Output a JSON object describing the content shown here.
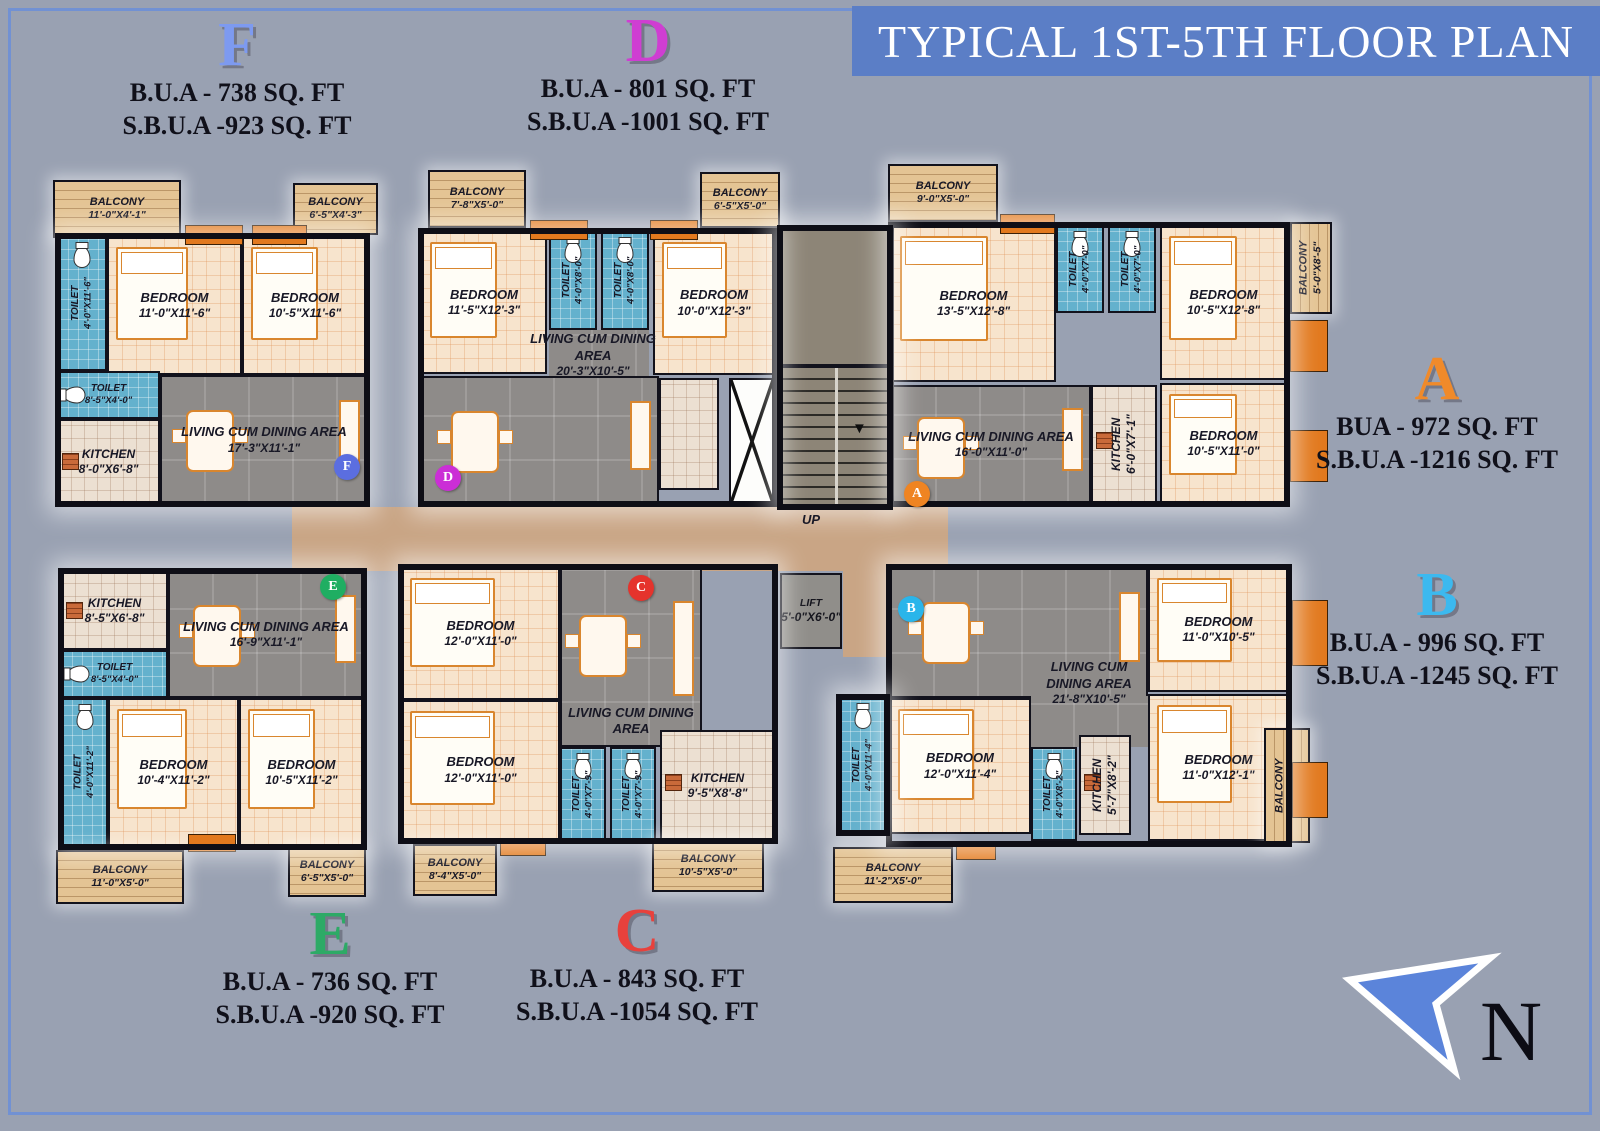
{
  "title": "TYPICAL 1ST-5TH FLOOR PLAN",
  "north": {
    "label": "N"
  },
  "units": [
    {
      "id": "F",
      "letter": "F",
      "color": "#7d9af0",
      "bua": "B.U.A - 738 SQ. FT",
      "sbua": "S.B.U.A -923 SQ. FT"
    },
    {
      "id": "D",
      "letter": "D",
      "color": "#cf3ed2",
      "bua": "B.U.A - 801 SQ. FT",
      "sbua": "S.B.U.A -1001 SQ. FT"
    },
    {
      "id": "A",
      "letter": "A",
      "color": "#f08a2a",
      "bua": "BUA - 972 SQ. FT",
      "sbua": "S.B.U.A -1216 SQ. FT"
    },
    {
      "id": "B",
      "letter": "B",
      "color": "#3cb9ef",
      "bua": "B.U.A - 996 SQ. FT",
      "sbua": "S.B.U.A -1245 SQ. FT"
    },
    {
      "id": "E",
      "letter": "E",
      "color": "#2daa66",
      "bua": "B.U.A - 736 SQ. FT",
      "sbua": "S.B.U.A -920 SQ. FT"
    },
    {
      "id": "C",
      "letter": "C",
      "color": "#e8413c",
      "bua": "B.U.A - 843 SQ. FT",
      "sbua": "S.B.U.A -1054 SQ. FT"
    }
  ],
  "markers": [
    {
      "u": "F",
      "x": 334,
      "y": 454,
      "color": "#5b6ee0"
    },
    {
      "u": "D",
      "x": 435,
      "y": 465,
      "color": "#cb2ed6"
    },
    {
      "u": "A",
      "x": 904,
      "y": 481,
      "color": "#ef8422"
    },
    {
      "u": "E",
      "x": 320,
      "y": 574,
      "color": "#1fae62"
    },
    {
      "u": "C",
      "x": 628,
      "y": 575,
      "color": "#e5332c"
    },
    {
      "u": "B",
      "x": 898,
      "y": 596,
      "color": "#2ab5ea"
    }
  ],
  "rooms": [
    {
      "u": "core",
      "k": "cor",
      "x": 292,
      "y": 507,
      "w": 656,
      "h": 64
    },
    {
      "u": "core",
      "k": "cor",
      "x": 843,
      "y": 569,
      "w": 46,
      "h": 88
    },
    {
      "u": "F",
      "k": "bal",
      "n": "BALCONY",
      "d": "11'-0\"X4'-1\"",
      "x": 53,
      "y": 180,
      "w": 128,
      "h": 58
    },
    {
      "u": "F",
      "k": "bal",
      "n": "BALCONY",
      "d": "6'-5\"X4'-3\"",
      "x": 293,
      "y": 183,
      "w": 85,
      "h": 52
    },
    {
      "u": "F",
      "k": "toi",
      "v": 1,
      "n": "TOILET",
      "d": "4'-0\"X11'-6\"",
      "x": 57,
      "y": 236,
      "w": 50,
      "h": 135
    },
    {
      "u": "F",
      "k": "bed",
      "n": "BEDROOM",
      "d": "11'-0\"X11'-6\"",
      "x": 107,
      "y": 236,
      "w": 135,
      "h": 139
    },
    {
      "u": "F",
      "k": "bed",
      "n": "BEDROOM",
      "d": "10'-5\"X11'-6\"",
      "x": 242,
      "y": 236,
      "w": 126,
      "h": 139
    },
    {
      "u": "F",
      "k": "toi",
      "n": "TOILET",
      "d": "8'-5\"X4'-0\"",
      "x": 57,
      "y": 371,
      "w": 103,
      "h": 48
    },
    {
      "u": "F",
      "k": "kit",
      "n": "KITCHEN",
      "d": "8'-0\"X6'-8\"",
      "x": 57,
      "y": 419,
      "w": 103,
      "h": 86
    },
    {
      "u": "F",
      "k": "liv",
      "n": "LIVING CUM DINING AREA",
      "d": "17'-3\"X11'-1\"",
      "x": 160,
      "y": 375,
      "w": 208,
      "h": 130
    },
    {
      "u": "D",
      "k": "bal",
      "n": "BALCONY",
      "d": "7'-8\"X5'-0\"",
      "x": 428,
      "y": 170,
      "w": 98,
      "h": 58
    },
    {
      "u": "D",
      "k": "bal",
      "n": "BALCONY",
      "d": "6'-5\"X5'-0\"",
      "x": 700,
      "y": 172,
      "w": 80,
      "h": 56
    },
    {
      "u": "D",
      "k": "bed",
      "n": "BEDROOM",
      "d": "11'-5\"X12'-3\"",
      "x": 421,
      "y": 231,
      "w": 126,
      "h": 143
    },
    {
      "u": "D",
      "k": "toi",
      "v": 1,
      "n": "TOILET",
      "d": "4'-0\"X8'-0\"",
      "x": 549,
      "y": 231,
      "w": 48,
      "h": 99
    },
    {
      "u": "D",
      "k": "toi",
      "v": 1,
      "n": "TOILET",
      "d": "4'-0\"X8'-0\"",
      "x": 601,
      "y": 231,
      "w": 48,
      "h": 99
    },
    {
      "u": "D",
      "k": "bed",
      "n": "BEDROOM",
      "d": "10'-0\"X12'-3\"",
      "x": 653,
      "y": 231,
      "w": 122,
      "h": 144
    },
    {
      "u": "D",
      "k": "livplain",
      "x": 549,
      "y": 330,
      "w": 100,
      "h": 48
    },
    {
      "u": "D",
      "k": "liv",
      "x": 421,
      "y": 376,
      "w": 238,
      "h": 129
    },
    {
      "u": "D",
      "k": "label",
      "n": "LIVING CUM DINING AREA",
      "d": "20'-3\"X10'-5\"",
      "x": 523,
      "y": 331,
      "w": 140,
      "h": 48
    },
    {
      "u": "D",
      "k": "kit",
      "x": 659,
      "y": 378,
      "w": 60,
      "h": 112
    },
    {
      "u": "D",
      "k": "shaft",
      "x": 729,
      "y": 378,
      "w": 46,
      "h": 127
    },
    {
      "u": "core",
      "k": "plain",
      "x": 780,
      "y": 228,
      "w": 110,
      "h": 138
    },
    {
      "u": "core",
      "k": "stair",
      "x": 780,
      "y": 366,
      "w": 110,
      "h": 141
    },
    {
      "u": "core",
      "k": "label",
      "n": "UP",
      "x": 791,
      "y": 512,
      "w": 40,
      "h": 16
    },
    {
      "u": "core",
      "k": "lift",
      "n": "LIFT",
      "d": "5'-0\"X6'-0\"",
      "x": 780,
      "y": 573,
      "w": 62,
      "h": 76
    },
    {
      "u": "A",
      "k": "bal",
      "n": "BALCONY",
      "d": "9'-0\"X5'-0\"",
      "x": 888,
      "y": 164,
      "w": 110,
      "h": 58
    },
    {
      "u": "A",
      "k": "bed",
      "n": "BEDROOM",
      "d": "13'-5\"X12'-8\"",
      "x": 891,
      "y": 225,
      "w": 165,
      "h": 157
    },
    {
      "u": "A",
      "k": "toi",
      "v": 1,
      "n": "TOILET",
      "d": "4'-0\"X7'-0\"",
      "x": 1056,
      "y": 225,
      "w": 48,
      "h": 88
    },
    {
      "u": "A",
      "k": "toi",
      "v": 1,
      "n": "TOILET",
      "d": "4'-0\"X7'-0\"",
      "x": 1108,
      "y": 225,
      "w": 48,
      "h": 88
    },
    {
      "u": "A",
      "k": "bed",
      "n": "BEDROOM",
      "d": "10'-5\"X12'-8\"",
      "x": 1160,
      "y": 225,
      "w": 127,
      "h": 155
    },
    {
      "u": "A",
      "k": "balv",
      "v": 1,
      "n": "BALCONY",
      "d": "5'-0\"X8'-5\"",
      "x": 1290,
      "y": 222,
      "w": 42,
      "h": 92
    },
    {
      "u": "A",
      "k": "bed",
      "n": "BEDROOM",
      "d": "10'-5\"X11'-0\"",
      "x": 1160,
      "y": 383,
      "w": 127,
      "h": 121
    },
    {
      "u": "A",
      "k": "liv",
      "n": "LIVING CUM DINING AREA",
      "d": "16'-0\"X11'-0\"",
      "x": 891,
      "y": 385,
      "w": 200,
      "h": 119
    },
    {
      "u": "A",
      "k": "kit",
      "v": 1,
      "n": "KITCHEN",
      "d": "6'-0\"X7'-1\"",
      "x": 1091,
      "y": 385,
      "w": 66,
      "h": 119
    },
    {
      "u": "E",
      "k": "kit",
      "n": "KITCHEN",
      "d": "8'-5\"X6'-8\"",
      "x": 61,
      "y": 571,
      "w": 107,
      "h": 79
    },
    {
      "u": "E",
      "k": "toi",
      "n": "TOILET",
      "d": "8'-5\"X4'-0\"",
      "x": 61,
      "y": 650,
      "w": 107,
      "h": 48
    },
    {
      "u": "E",
      "k": "liv",
      "n": "LIVING CUM DINING AREA",
      "d": "16'-9\"X11'-1\"",
      "x": 168,
      "y": 571,
      "w": 196,
      "h": 127
    },
    {
      "u": "E",
      "k": "toi",
      "v": 1,
      "n": "TOILET",
      "d": "4'-0\"X11'-2\"",
      "x": 61,
      "y": 698,
      "w": 47,
      "h": 149
    },
    {
      "u": "E",
      "k": "bed",
      "n": "BEDROOM",
      "d": "10'-4\"X11'-2\"",
      "x": 108,
      "y": 698,
      "w": 131,
      "h": 149
    },
    {
      "u": "E",
      "k": "bed",
      "n": "BEDROOM",
      "d": "10'-5\"X11'-2\"",
      "x": 239,
      "y": 698,
      "w": 125,
      "h": 149
    },
    {
      "u": "E",
      "k": "bal",
      "n": "BALCONY",
      "d": "11'-0\"X5'-0\"",
      "x": 56,
      "y": 850,
      "w": 128,
      "h": 54
    },
    {
      "u": "E",
      "k": "bal",
      "n": "BALCONY",
      "d": "6'-5\"X5'-0\"",
      "x": 288,
      "y": 847,
      "w": 78,
      "h": 50
    },
    {
      "u": "C",
      "k": "bed",
      "n": "BEDROOM",
      "d": "12'-0\"X11'-0\"",
      "x": 401,
      "y": 567,
      "w": 159,
      "h": 133
    },
    {
      "u": "C",
      "k": "bed",
      "n": "BEDROOM",
      "d": "12'-0\"X11'-0\"",
      "x": 401,
      "y": 700,
      "w": 159,
      "h": 140
    },
    {
      "u": "C",
      "k": "liv",
      "x": 560,
      "y": 567,
      "w": 142,
      "h": 180
    },
    {
      "u": "C",
      "k": "label",
      "n": "LIVING CUM DINING AREA",
      "x": 565,
      "y": 698,
      "w": 132,
      "h": 46
    },
    {
      "u": "C",
      "k": "toi",
      "v": 1,
      "n": "TOILET",
      "d": "4'-0\"X7'-9\"",
      "x": 560,
      "y": 747,
      "w": 46,
      "h": 94
    },
    {
      "u": "C",
      "k": "toi",
      "v": 1,
      "n": "TOILET",
      "d": "4'-0\"X7'-9\"",
      "x": 610,
      "y": 747,
      "w": 46,
      "h": 94
    },
    {
      "u": "C",
      "k": "kit",
      "n": "KITCHEN",
      "d": "9'-5\"X8'-8\"",
      "x": 660,
      "y": 730,
      "w": 115,
      "h": 111
    },
    {
      "u": "C",
      "k": "bal",
      "n": "BALCONY",
      "d": "8'-4\"X5'-0\"",
      "x": 413,
      "y": 844,
      "w": 84,
      "h": 52
    },
    {
      "u": "C",
      "k": "bal",
      "n": "BALCONY",
      "d": "10'-5\"X5'-0\"",
      "x": 652,
      "y": 840,
      "w": 112,
      "h": 52
    },
    {
      "u": "B",
      "k": "liv",
      "x": 889,
      "y": 567,
      "w": 259,
      "h": 131
    },
    {
      "u": "B",
      "k": "livplain",
      "x": 1031,
      "y": 696,
      "w": 117,
      "h": 51
    },
    {
      "u": "B",
      "k": "label",
      "n": "LIVING CUM DINING AREA",
      "d": "21'-8\"X10'-5\"",
      "x": 1028,
      "y": 652,
      "w": 122,
      "h": 62
    },
    {
      "u": "B",
      "k": "bed",
      "n": "BEDROOM",
      "d": "11'-0\"X10'-5\"",
      "x": 1148,
      "y": 567,
      "w": 141,
      "h": 125
    },
    {
      "u": "B",
      "k": "toi",
      "v": 1,
      "n": "TOILET",
      "d": "4'-0\"X11'-4\"",
      "x": 839,
      "y": 697,
      "w": 48,
      "h": 136
    },
    {
      "u": "B",
      "k": "bed",
      "n": "BEDROOM",
      "d": "12'-0\"X11'-4\"",
      "x": 889,
      "y": 698,
      "w": 142,
      "h": 136
    },
    {
      "u": "B",
      "k": "toi",
      "v": 1,
      "n": "TOILET",
      "d": "4'-0\"X8'-2\"",
      "x": 1031,
      "y": 747,
      "w": 46,
      "h": 94
    },
    {
      "u": "B",
      "k": "kit",
      "v": 1,
      "n": "KITCHEN",
      "d": "5'-7\"X8'-2\"",
      "x": 1079,
      "y": 735,
      "w": 52,
      "h": 100
    },
    {
      "u": "B",
      "k": "bed",
      "n": "BEDROOM",
      "d": "11'-0\"X12'-1\"",
      "x": 1148,
      "y": 694,
      "w": 141,
      "h": 147
    },
    {
      "u": "B",
      "k": "bal",
      "n": "BALCONY",
      "d": "11'-2\"X5'-0\"",
      "x": 833,
      "y": 847,
      "w": 120,
      "h": 56
    },
    {
      "u": "B",
      "k": "balv",
      "v": 1,
      "n": "BALCONY",
      "d": "4'-0\"X7'-1\"",
      "x": 1264,
      "y": 728,
      "w": 46,
      "h": 115
    },
    {
      "u": "F",
      "k": "wall",
      "x": 55,
      "y": 233,
      "w": 315,
      "h": 274
    },
    {
      "u": "D",
      "k": "wall",
      "x": 418,
      "y": 228,
      "w": 360,
      "h": 279
    },
    {
      "u": "A",
      "k": "wall",
      "x": 888,
      "y": 222,
      "w": 402,
      "h": 285
    },
    {
      "u": "core",
      "k": "wall",
      "x": 777,
      "y": 225,
      "w": 116,
      "h": 285
    },
    {
      "u": "E",
      "k": "wall",
      "x": 58,
      "y": 568,
      "w": 309,
      "h": 282
    },
    {
      "u": "C",
      "k": "wall",
      "x": 398,
      "y": 564,
      "w": 380,
      "h": 280
    },
    {
      "u": "B",
      "k": "wall",
      "x": 886,
      "y": 564,
      "w": 406,
      "h": 283
    },
    {
      "u": "B",
      "k": "wall",
      "x": 836,
      "y": 694,
      "w": 54,
      "h": 142
    },
    {
      "u": "F",
      "k": "acc",
      "x": 185,
      "y": 225,
      "w": 58,
      "h": 20
    },
    {
      "u": "F",
      "k": "acc",
      "x": 252,
      "y": 225,
      "w": 55,
      "h": 20
    },
    {
      "u": "D",
      "k": "acc",
      "x": 530,
      "y": 220,
      "w": 58,
      "h": 20
    },
    {
      "u": "D",
      "k": "acc",
      "x": 650,
      "y": 220,
      "w": 48,
      "h": 20
    },
    {
      "u": "A",
      "k": "acc",
      "x": 1000,
      "y": 214,
      "w": 55,
      "h": 20
    },
    {
      "u": "A",
      "k": "acc",
      "x": 1290,
      "y": 320,
      "w": 38,
      "h": 52
    },
    {
      "u": "A",
      "k": "acc",
      "x": 1290,
      "y": 430,
      "w": 38,
      "h": 52
    },
    {
      "u": "B",
      "k": "acc",
      "x": 1292,
      "y": 600,
      "w": 36,
      "h": 66
    },
    {
      "u": "B",
      "k": "acc",
      "x": 1292,
      "y": 762,
      "w": 36,
      "h": 56
    },
    {
      "u": "E",
      "k": "acc",
      "x": 188,
      "y": 834,
      "w": 48,
      "h": 18
    },
    {
      "u": "C",
      "k": "acc",
      "x": 500,
      "y": 838,
      "w": 46,
      "h": 18
    },
    {
      "u": "B",
      "k": "acc",
      "x": 956,
      "y": 842,
      "w": 40,
      "h": 18
    }
  ]
}
